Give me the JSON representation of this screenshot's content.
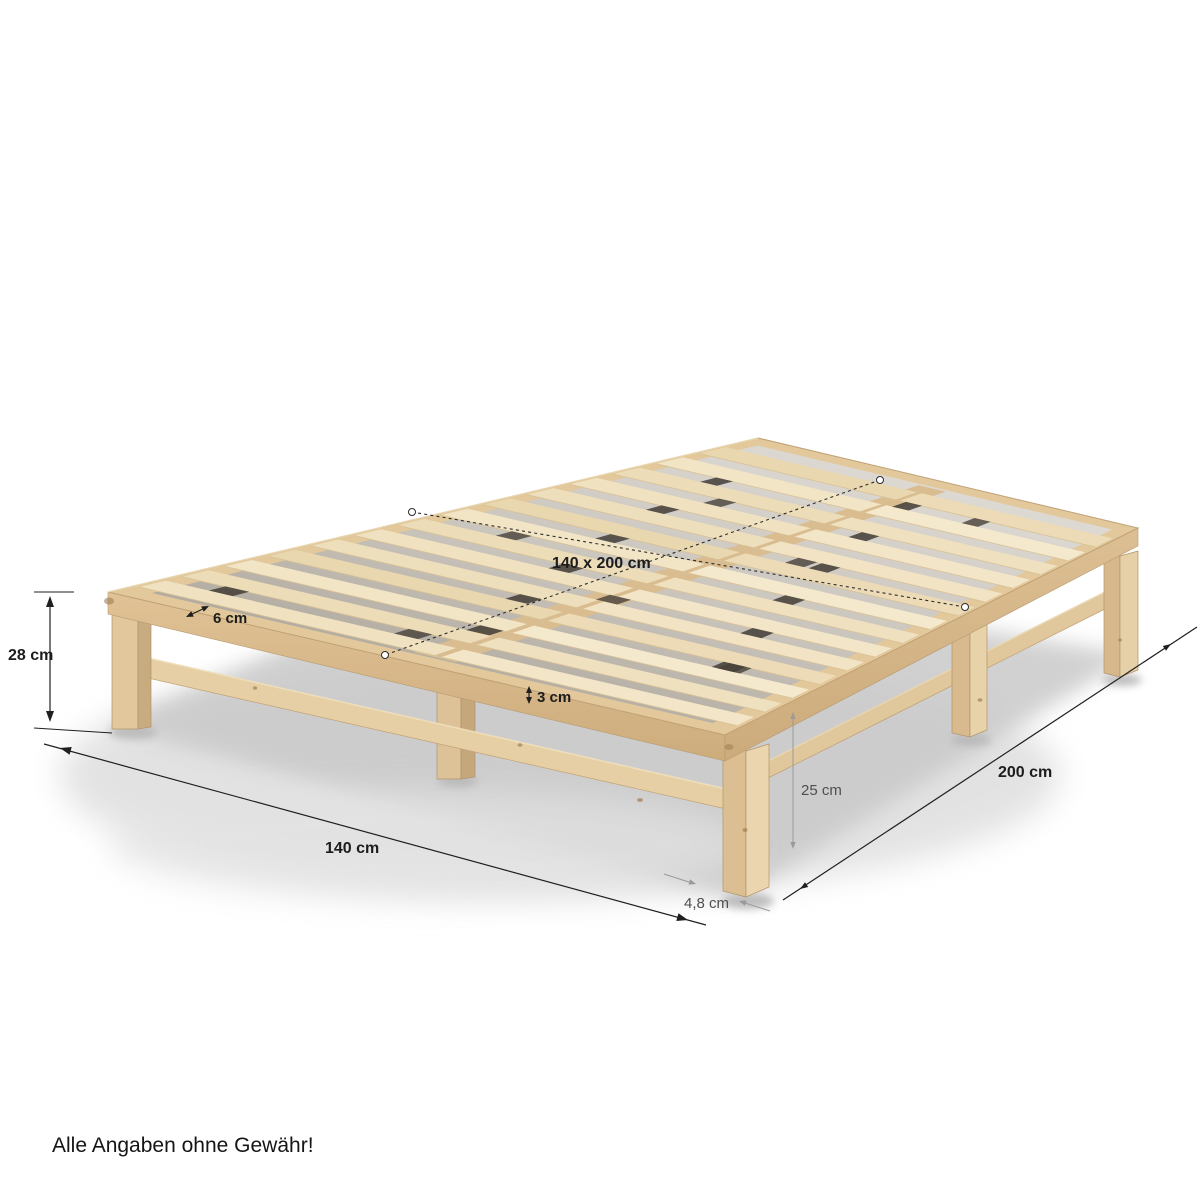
{
  "background": "#ffffff",
  "product": {
    "type": "wooden-pallet-bed-illustration",
    "wood_light": "#f1e3c2",
    "wood_rail": "#e3c99c",
    "wood_dark": "#c8aa7e"
  },
  "annotations": {
    "frame_height": "28 cm",
    "surface_size": "140 x 200 cm",
    "slat_width": "6 cm",
    "slat_thickness": "3 cm",
    "under_clearance": "25 cm",
    "leg_thickness": "4,8 cm",
    "bed_width": "140 cm",
    "bed_length": "200 cm"
  },
  "disclaimer": "Alle Angaben ohne Gewähr!",
  "annotation_colors": {
    "primary": "#1c1c1c",
    "muted": "#4f4f4f",
    "guide": "#9a9a9a"
  }
}
